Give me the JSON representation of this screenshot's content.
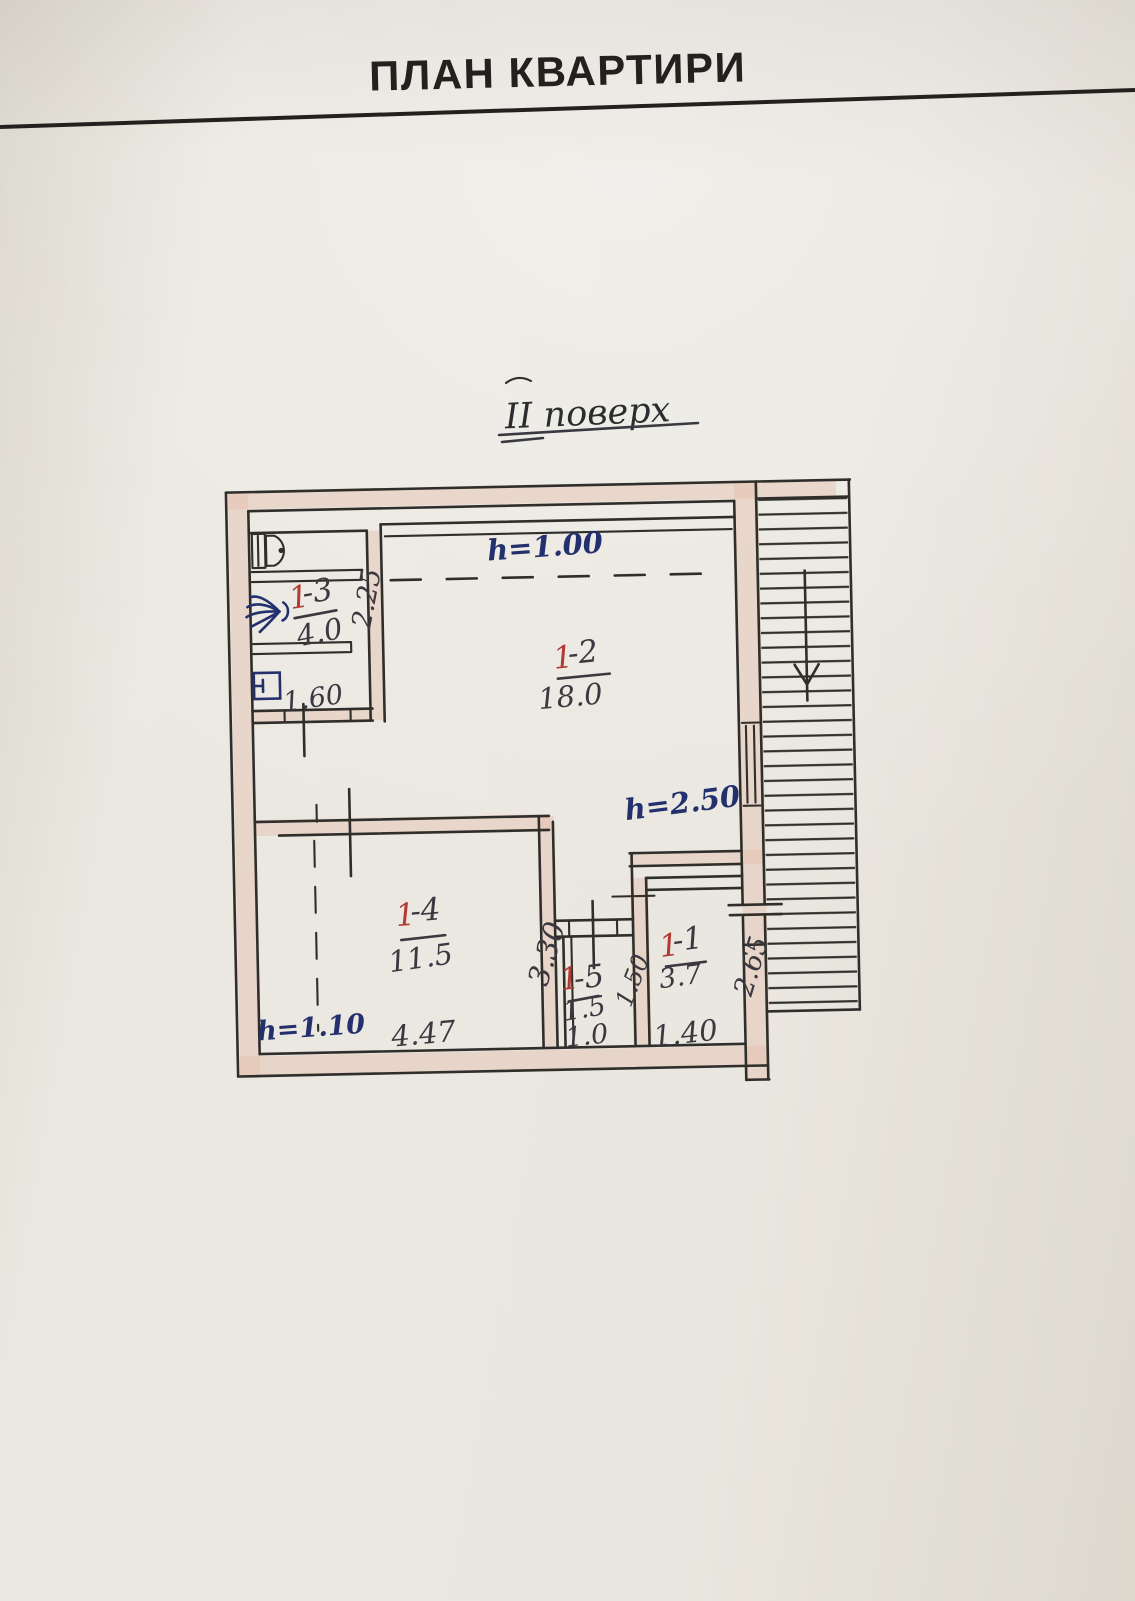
{
  "page": {
    "title": "ПЛАН КВАРТИРИ",
    "subtitle": "ІІ поверх"
  },
  "plan": {
    "heights": {
      "room2": "h=1.00",
      "hall": "h=2.50",
      "room4": "h=1.10"
    },
    "rooms": [
      {
        "key": "1-3",
        "num_prefix": "1",
        "num_suffix": "-3",
        "area": "4.0",
        "width": "1.60",
        "depth": "2.25"
      },
      {
        "key": "1-2",
        "num_prefix": "1",
        "num_suffix": "-2",
        "area": "18.0"
      },
      {
        "key": "1-4",
        "num_prefix": "1",
        "num_suffix": "-4",
        "area": "11.5",
        "width": "4.47",
        "depth": "3.30"
      },
      {
        "key": "1-5",
        "num_prefix": "1",
        "num_suffix": "-5",
        "area": "1.5",
        "width": "1.0",
        "depth": "1.50"
      },
      {
        "key": "1-1",
        "num_prefix": "1",
        "num_suffix": "-1",
        "area": "3.7",
        "width": "1.40",
        "depth": "2.65"
      }
    ],
    "colors": {
      "ink": "#2f2e2a",
      "handwriting": "#3a3940",
      "red_label": "#b23a32",
      "blue_label": "#23306d",
      "wall_fill": "#e4bfae"
    }
  }
}
